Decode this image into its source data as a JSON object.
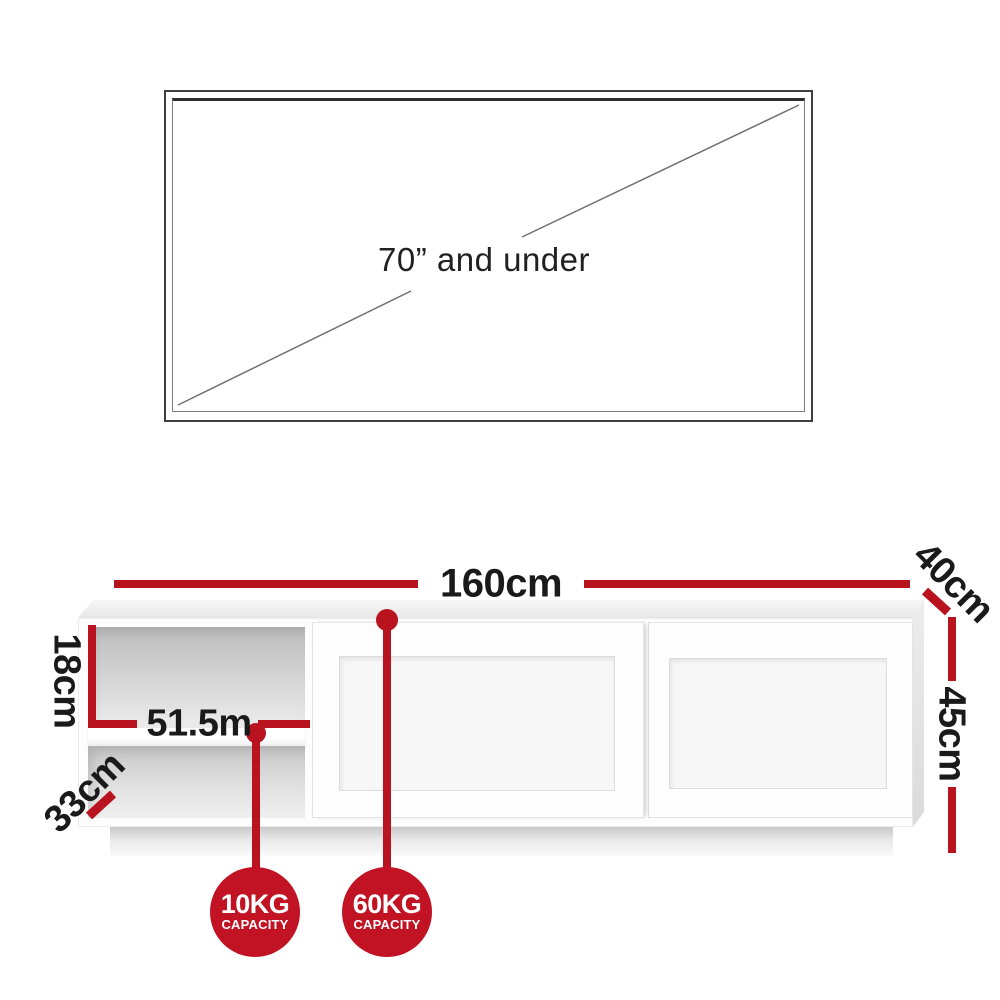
{
  "tv": {
    "size_label": "70” and under"
  },
  "dimensions": {
    "width": "160cm",
    "depth": "40cm",
    "height": "45cm",
    "shelf_height": "18cm",
    "shelf_width": "51.5m",
    "shelf_depth": "33cm"
  },
  "badges": [
    {
      "value": "10KG",
      "caption": "CAPACITY"
    },
    {
      "value": "60KG",
      "caption": "CAPACITY"
    }
  ],
  "colors": {
    "dimension_red": "#b91320",
    "badge_red": "#c11323",
    "text_dark": "#1a1a1a",
    "tv_outline": "#3f3f3f"
  }
}
